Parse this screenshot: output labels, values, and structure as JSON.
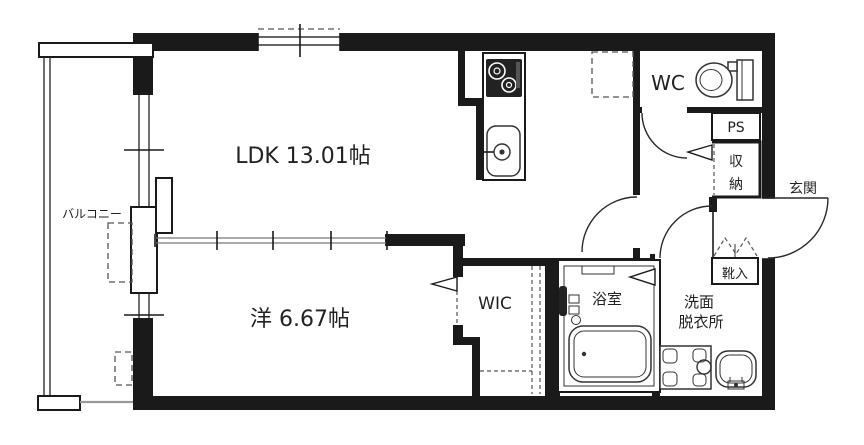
{
  "floorplan": {
    "labels": {
      "ldk": "LDK 13.01帖",
      "western_room": "洋 6.67帖",
      "wic": "WIC",
      "wc": "WC",
      "bathroom": "浴室",
      "washroom_line1": "洗面",
      "washroom_line2": "脱衣所",
      "ps": "PS",
      "storage_char1": "収",
      "storage_char2": "納",
      "shoe_cabinet": "靴入",
      "entrance": "玄関",
      "balcony": "バルコニー"
    },
    "colors": {
      "wall": "#1a1a1a",
      "line": "#333333",
      "dash": "#555555",
      "gray": "#999999",
      "text": "#222222",
      "background": "#ffffff"
    }
  }
}
